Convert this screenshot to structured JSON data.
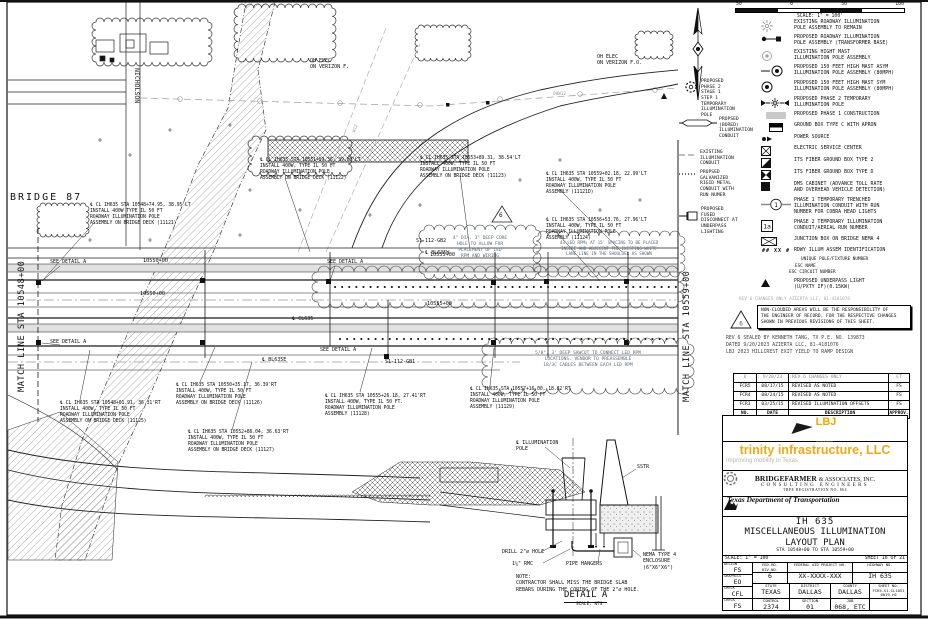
{
  "scale_bar": {
    "ticks": [
      "50",
      "0",
      "50",
      "100"
    ],
    "label": "SCALE: 1\" = 100'"
  },
  "legend": {
    "id_code": "## XX #",
    "run1": "1",
    "run2": "1a",
    "right_items": [
      "EXISTING ROADWAY ILLUMINATION\nPOLE ASSEMBLY TO REMAIN",
      "PROPOSED ROADWAY ILLUMINATION\nPOLE ASSEMBLY (TRANSFORMER BASE)",
      "EXISTING HIGHT MAST\nILLUMINATION POLE ASSEMBLY",
      "PROPOSED 150 FEET HIGH MAST ASYM\nILLUMINATION POLE ASSEMBLY (80MPH)",
      "PROPOSED 150 FEET HIGH MAST SYM\nILLUMINATION POLE ASSEMBLY (80MPH)",
      "PROPOSED PHASE 2 TEMPORARY\nILLUMINATION POLE",
      "PROPOSED PHASE 1 CONSTRUCTION",
      "GROUND BOX TYPE C WITH APRON",
      "POWER SOURCE",
      "ELECTRIC SERVICE CENTER",
      "ITS FIBER GROUND BOX TYPE 2",
      "ITS FIBER GROUND BOX TYPE D",
      "DMS CABINET (ADVANCE TOLL RATE\nAND OVERHEAD VEHICLE DETECTION)",
      "PHASE 1 TEMPORARY TRENCHED\nILLUMINATION CONDUIT WITH RUN\nNUMBER FOR COBRA HEAD LIGHTS",
      "PHASE 2 TEMPORARY ILLUMINATION\nCONDUIT/AERIAL RUN NUMBER",
      "JUNCTION BOX ON BRIDGE NEMA 4",
      "RDWY ILLUM ASSEM IDENTIFICATION",
      "PROPOSED UNDERPASS LIGHT\n(U/PXTY IF)(0.15KW)"
    ],
    "id_subs": [
      "UNIQUE POLE/FIXTURE NUMBER",
      "ESC NAME",
      "ESC CIRCUIT NUMBER"
    ],
    "left_items": [
      "PROPOSED\nPHASE 2\nSTAGE 1\nSTEP 1\nTEMPORARY\nILLUMINATION\nPOLE",
      "PROPSED\n(BORED)\nILLUMINATION\nCONDUIT",
      "EXISTING\nILLUMINATION\nCONDUIT",
      "PROPSED\nGALVANIZED\nRIGID METAL\nCONDUIT WITH\nRUN NUMER",
      "PROPOSED\nFUSED\nDISCONNECT AT\nUNDERPASS\nLIGHTING"
    ]
  },
  "plan": {
    "bridge": "BRIDGE 87",
    "nicholson": "NICHOLSON",
    "ml_left": "MATCH LINE STA 10548+00",
    "ml_right": "MATCH LINE STA 10559+00",
    "oh1": "OH ELEC\nON VERIZON F.",
    "oh2": "OH ELEC\nON VERIZON F.O.",
    "ohw12": "OHW12",
    "w12": "W12",
    "sta_10550": "10550+00",
    "sta_10555": "10555+00",
    "see_detail": "SEE DETAIL A",
    "gb1": "S1-112-GB1",
    "gb2": "S1-112-GB2",
    "bl635w": "℄ BL635W",
    "bl635e": "℄ BL635E",
    "cl635": "℄ CL635",
    "rev_tri": "6",
    "callouts": [
      "℄ CL IH635 STA 10548+74.95, 38.95'LT\nINSTALL 400W TYPE IL 50 FT\nROADWAY ILLUMINATION POLE\nASSEMBLY ON BRIDGE DECK (11121)",
      "℄ CL IH635 STA 10551+59.36, 39.00'LT\nINSTALL 400W, TYPE IL 50 FT\nROADWAY ILLUMINATION POLE\nASSEMBLY ON BRIDGE DECK (11122)",
      "℄ CL IH635 STA 10553+89.31, 38.54'LT\nINSTALL 400W, TYPE IL 50 FT\nROADWAY ILLUMINATION POLE\nASSEMBLY ON BRIDGE DECK (11123)",
      "℄ CL IH635 STA 10559+02.18, 22.99'LT\nINSTALL 400W, TYPE IL 50 FT\nROADWAY ILLUMINATION POLE\nASSEMBLY (11121D)",
      "℄ CL IH635 STA 10556+53.76, 27.96'LT\nINSTALL 400W, TYPE IL 50 FT\nROADWAY ILLUMINATION POLE\nASSEMBLY (11124)",
      "℄ CL IH635 STA 10548+01.91, 36.31'RT\nINSTALL 400W, TYPE IL 50 FT\nROADWAY ILLUMINATION POLE\nASSEMBLY ON BRIDGE DECK (11125)",
      "℄ CL IH635 STA 10550+35.17, 36.39'RT\nINSTALL 400W, TYPE IL 50 FT\nROADWAY ILLUMINATION POLE\nASSEMBLY ON BRIDGE DECK (11126)",
      "℄ CL IH635 STA 10552+86.04, 36.63'RT\nINSTALL 400W, TYPE IL 50 FT\nROADWAY ILLUMINATION POLE\nASSEMBLY ON BRIDGE DECK (11127)",
      "℄ CL IH635 STA 10555+26.18, 27.41'RT\nINSTALL 400W, TYPE IL 50 FT.\nROADWAY ILLUMINATION POLE\nASSEMBLY (11128)",
      "℄ CL IH635 STA 10557+16.00, 18.82'RT\nINSTALL 400W, TYPE IL 50 FT\nROADWAY ILLUMINATION POLE\nASSEMBLY (11129)"
    ],
    "notes": [
      "4\" DIA. 3\" DEEP CORE\nHOLE TO ALLOW FOR\nPLACEMENT OF LED\nRPM AND WIRING",
      "43 LED RPMs AT 15' SPACING TO BE PLACED\nINSIDE AND ADJECENT THE EXISTING WHITE\nLANE LINE IN THE SHOULDER AS SHOWN",
      "5/8\", 3' DEEP SAWCUT TO CONNECT LED RPM\nLOCATIONS. VENDOR TO PREASSEMBLE\n18/3C CABLES BETWEEN EACH LED RPM"
    ]
  },
  "detail_a": {
    "title": "DETAIL A",
    "scale": "SCALE: NTS",
    "pole": "℄ ILLUMINATION\nPOLE",
    "sstr": "SSTR",
    "drill": "DRILL 2\"∅ HOLE",
    "rmc": "1¼\" RMC",
    "hangers": "PIPE HANGERS",
    "nema": "NEMA TYPE 4\nENCLOSURE\n(6\"X6\"X6\")",
    "note": "NOTE:\nCONTRACTOR SHALL MISS THE BRIDGE SLAB\nREBARS DURING THE CORING OF THE 2\"∅ HOLE."
  },
  "notes_panel": {
    "grayline": "REV 6 CHANGES ONLY        AZIERTA LLC, 81-4181076",
    "warning": "NON-CLOUDED AREAS WILL BE THE RESPONSIBILITY OF\nTHE ENGINEER OF RECORD, FOR THE RESPECTIVE CHANGES\nSHOWN IN PREVIOUS REVISIONS OF THIS SHEET.",
    "tri": "6",
    "seal": "REV 6 SEALED BY KENNETH TANG, TX P.E. NO. 139873\nDATED 9/20/2023      AZIERTA LLC, 81-4181076\nLBJ 2023 HILLCREST EXIT YIELD TO RAMP DESIGN"
  },
  "revisions": {
    "rows": [
      {
        "no": "6",
        "date": "9/20/23",
        "desc": "REV 6 CHANGES ONLY",
        "approv": "ET"
      },
      {
        "no": "FCR5",
        "date": "08/17/15",
        "desc": "REVISED AS NOTED",
        "approv": "FS"
      },
      {
        "no": "FCR4",
        "date": "08/24/15",
        "desc": "REVISED AS NOTED",
        "approv": "FS"
      },
      {
        "no": "FCR3",
        "date": "03/25/15",
        "desc": "REVISED ILLUMINATION OFFSETS",
        "approv": "FS"
      }
    ],
    "header": {
      "no": "NO.",
      "date": "DATE",
      "desc": "DESCRIPTION",
      "approv": "APPROV."
    }
  },
  "logos": {
    "lbj": {
      "name": "LBJ",
      "sub": "express"
    },
    "trinity": {
      "name": "trinity infrastructure, LLC",
      "tagline": "Improving mobility in Texas"
    },
    "bridgefarmer": {
      "name": "BRIDGEFARMER",
      "rest": "& ASSOCIATES, INC.",
      "line2": "CONSULTING ENGINEERS",
      "line3": "TBPE REGISTRATION NO. 864"
    },
    "txdot": {
      "name": "Texas Department of Transportation",
      "copyright": "©2015"
    }
  },
  "title_block": {
    "line1": "IH 635",
    "line2": "MISCELLANEOUS ILLUMINATION",
    "line3": "LAYOUT PLAN",
    "line4": "STA 10548+00 TO STA 10559+00",
    "scale": "SCALE: 1\" = 100'",
    "sheet": "SHEET 16 OF 21"
  },
  "info": {
    "design_label": "DESIGN",
    "design": "FS",
    "graphics_label": "GRAPHICS",
    "graphics": "EO",
    "check1_label": "CHECK",
    "check1": "CFL",
    "check2_label": "CHECK",
    "check2": "FS",
    "fedrd_label": "FED.RD.\nDIV.NO.",
    "fedrd": "6",
    "fap_label": "FEDERAL AID PROJECT NO.",
    "fap": "XX-XXXX-XXX",
    "hwy_label": "HIGHWAY NO.",
    "hwy": "IH 635",
    "state_label": "STATE",
    "state": "TEXAS",
    "district_label": "DISTRICT",
    "district": "DALLAS",
    "county_label": "COUNTY",
    "county": "DALLAS",
    "sheetno_label": "SHEET NO.",
    "sheetno": "FCR5-S1-IL1051\n0019-r0",
    "control_label": "CONTROL",
    "control": "2374",
    "section_label": "SECTION",
    "section": "01",
    "job_label": "JOB",
    "job": "068, ETC"
  }
}
